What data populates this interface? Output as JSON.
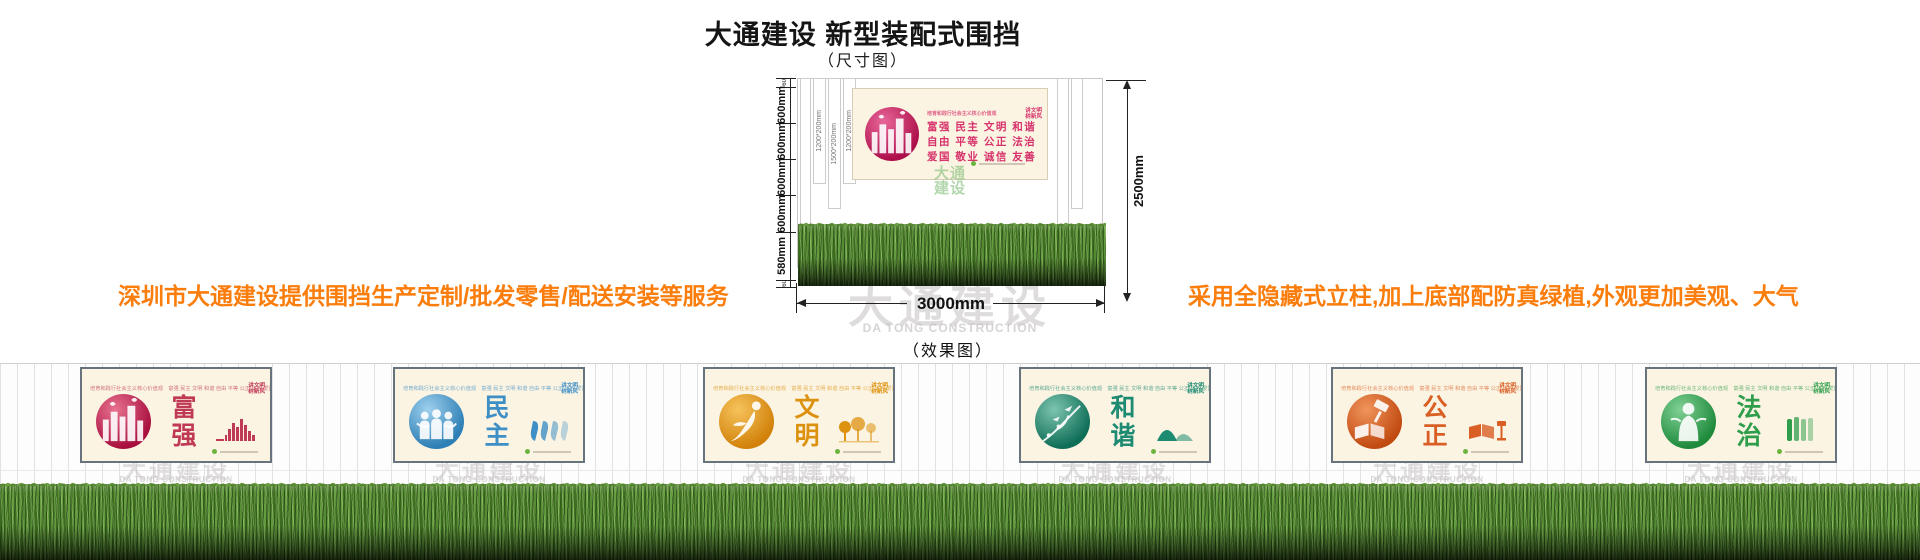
{
  "header": {
    "title": "大通建设 新型装配式围挡",
    "subtitle": "（尺寸图）"
  },
  "notes": {
    "left": "深圳市大通建设提供围挡生产定制/批发零售/配送安装等服务",
    "right": "采用全隐藏式立柱,加上底部配防真绿植,外观更加美观、大气"
  },
  "size_diagram": {
    "left_dims": [
      "60",
      "600mm",
      "600mm",
      "600mm",
      "600mm",
      "580mm",
      "60"
    ],
    "post_labels": [
      "1200*200mm",
      "1500*200mm",
      "1200*200mm"
    ],
    "height_dim": "2500mm",
    "width_dim": "3000mm",
    "banner": {
      "top_line": "培育和践行社会主义核心价值观",
      "value_rows": [
        "富强  民主  文明  和谐",
        "自由  平等  公正  法治",
        "爱国  敬业  诚信  友善"
      ],
      "badge_lines": [
        "讲文明",
        "树新风"
      ],
      "accent": "#d6336c"
    },
    "effect_label": "（效果图）"
  },
  "watermark": {
    "cn": "大通建设",
    "en": "DA TONG CONSTRUCTION",
    "cn_stacked": [
      "大通",
      "建设"
    ]
  },
  "effect_row": {
    "panel_top_line": "培育和践行社会主义核心价值观　富强 民主 文明 和谐 自由 平等 公正 法治 爱国 敬业 诚信 友善",
    "badge_lines": [
      "讲文明",
      "树新风"
    ],
    "panels": [
      {
        "word": [
          "富",
          "强"
        ],
        "color": "#c03a55",
        "circle": "#a80f3e",
        "circle_hi": "#e8728f",
        "art_icon": "city-papercut-icon",
        "side_icon": "city-skyline-icon"
      },
      {
        "word": [
          "民",
          "主"
        ],
        "color": "#3e8fc6",
        "circle": "#2d7fb5",
        "circle_hi": "#9fd0ee",
        "art_icon": "people-papercut-icon",
        "side_icon": "thumbs-icon"
      },
      {
        "word": [
          "文",
          "明"
        ],
        "color": "#dd920f",
        "circle": "#d2820a",
        "circle_hi": "#f6c35c",
        "art_icon": "dancer-papercut-icon",
        "side_icon": "trees-icon"
      },
      {
        "word": [
          "和",
          "谐"
        ],
        "color": "#1d8a72",
        "circle": "#0f6e57",
        "circle_hi": "#7cc4af",
        "art_icon": "birds-papercut-icon",
        "side_icon": "mountains-icon"
      },
      {
        "word": [
          "公",
          "正"
        ],
        "color": "#d95f25",
        "circle": "#c14a10",
        "circle_hi": "#f0945c",
        "art_icon": "gavel-papercut-icon",
        "side_icon": "book-gavel-icon"
      },
      {
        "word": [
          "法",
          "治"
        ],
        "color": "#2f9e4c",
        "circle": "#1f8a3c",
        "circle_hi": "#7fd194",
        "art_icon": "figure-papercut-icon",
        "side_icon": "seal-icon"
      }
    ]
  },
  "colors": {
    "note_orange": "#fb7d0c",
    "panel_bg": "#fbf4e3",
    "panel_border": "#68747d",
    "dim_line": "#222222",
    "grass_green": "#4e8030",
    "watermark_gray": "#c9c5c5"
  }
}
